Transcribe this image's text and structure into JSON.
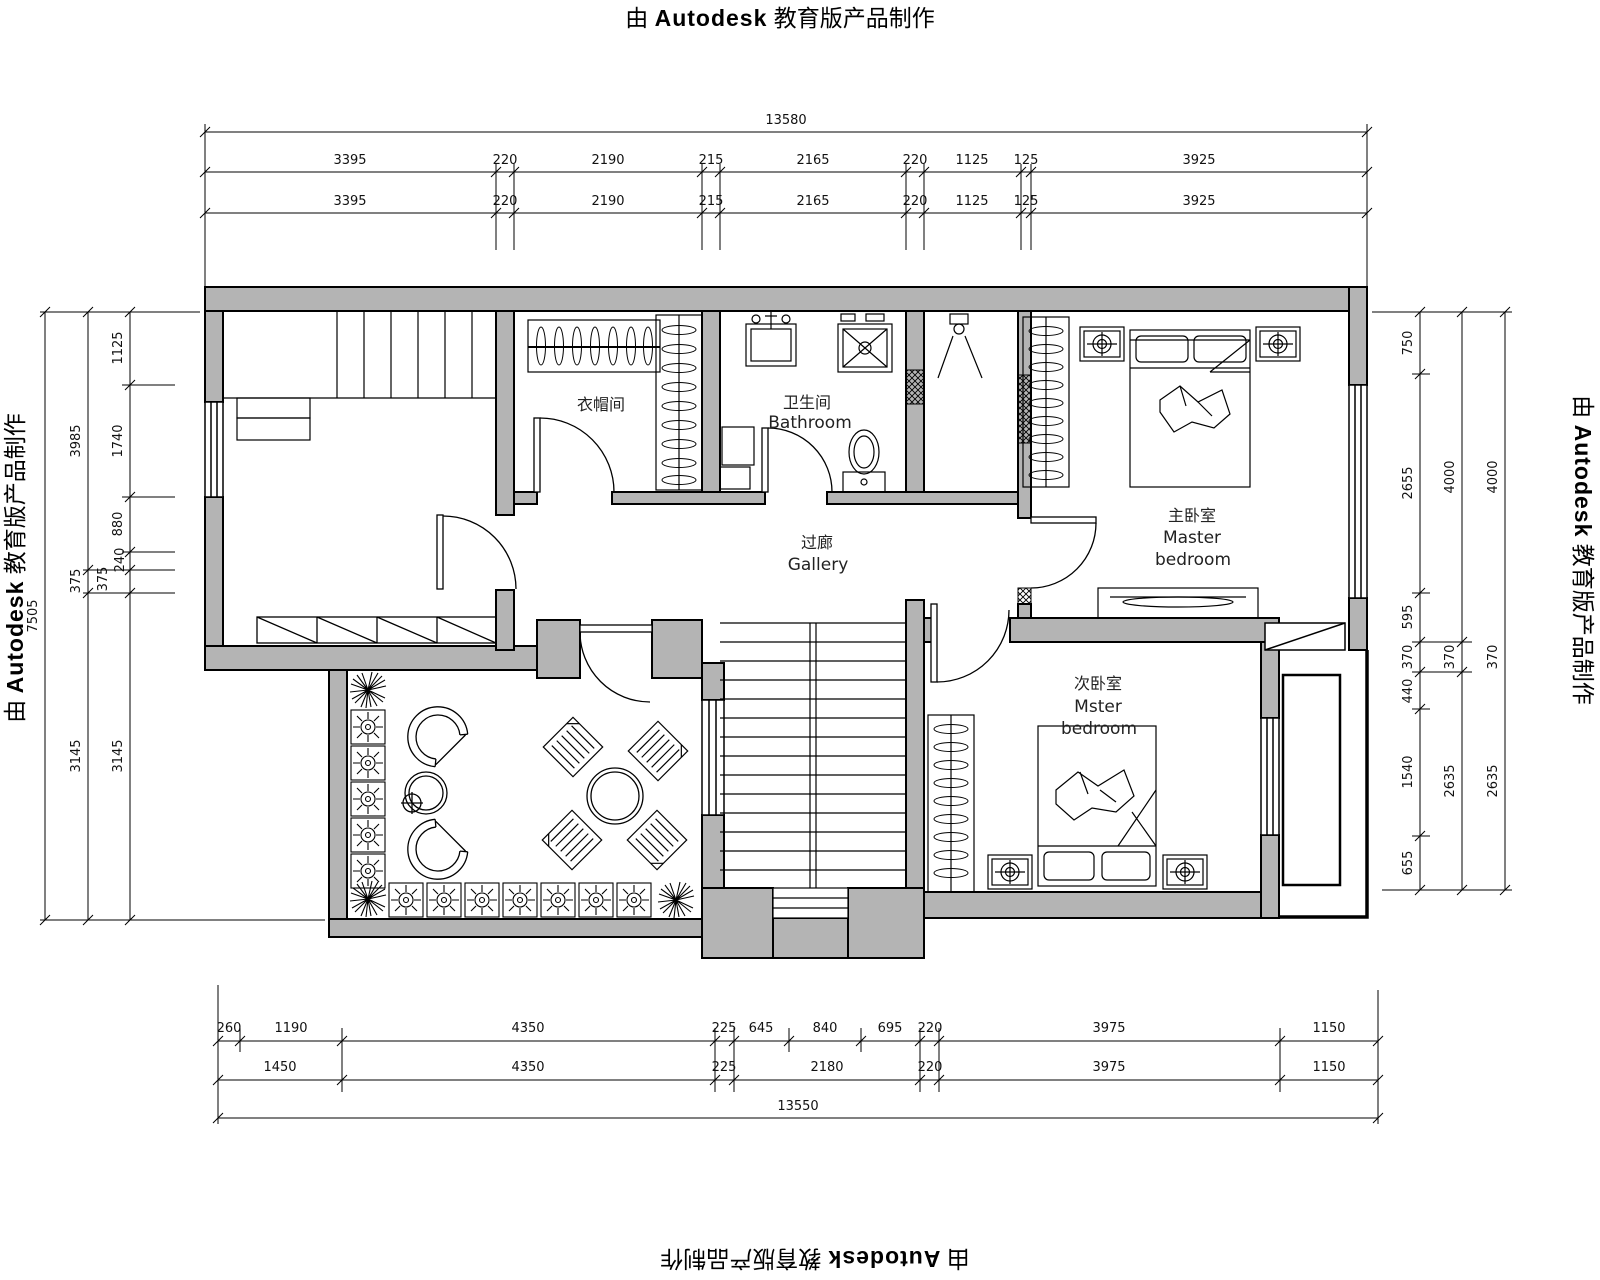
{
  "watermark": {
    "prefix": "由",
    "brand": "Autodesk",
    "suffix": "教育版产品制作"
  },
  "rooms": {
    "cloakroom": {
      "zh": "衣帽间"
    },
    "bathroom": {
      "zh": "卫生间",
      "en": "Bathroom"
    },
    "gallery": {
      "zh": "过廊",
      "en": "Gallery"
    },
    "master": {
      "zh": "主卧室",
      "en1": "Master",
      "en2": "bedroom"
    },
    "second": {
      "zh": "次卧室",
      "en1": "Mster",
      "en2": "bedroom"
    }
  },
  "dims": {
    "top": {
      "total": "13580",
      "row1": [
        "3395",
        "220",
        "2190",
        "215",
        "2165",
        "220",
        "1125",
        "125",
        "3925"
      ],
      "row2": [
        "3395",
        "220",
        "2190",
        "215",
        "2165",
        "220",
        "1125",
        "125",
        "3925"
      ]
    },
    "bottom": {
      "row1": [
        "260",
        "1190",
        "4350",
        "225",
        "645",
        "840",
        "695",
        "220",
        "3975",
        "1150"
      ],
      "row2": [
        "1450",
        "4350",
        "225",
        "2180",
        "220",
        "3975",
        "1150"
      ],
      "total": "13550"
    },
    "left": {
      "total": "7505",
      "mid": [
        "3985",
        "375",
        "3145"
      ],
      "inner": [
        "1125",
        "1740",
        "880",
        "240",
        "375",
        "3145"
      ]
    },
    "right": {
      "inner": [
        "750",
        "2655",
        "595",
        "370",
        "440",
        "1540",
        "655"
      ],
      "mid": [
        "4000",
        "370",
        "2635"
      ],
      "outer": [
        "4000",
        "370",
        "2635"
      ]
    }
  },
  "colors": {
    "wall": "#b4b4b4",
    "line": "#000000",
    "bg": "#ffffff"
  }
}
